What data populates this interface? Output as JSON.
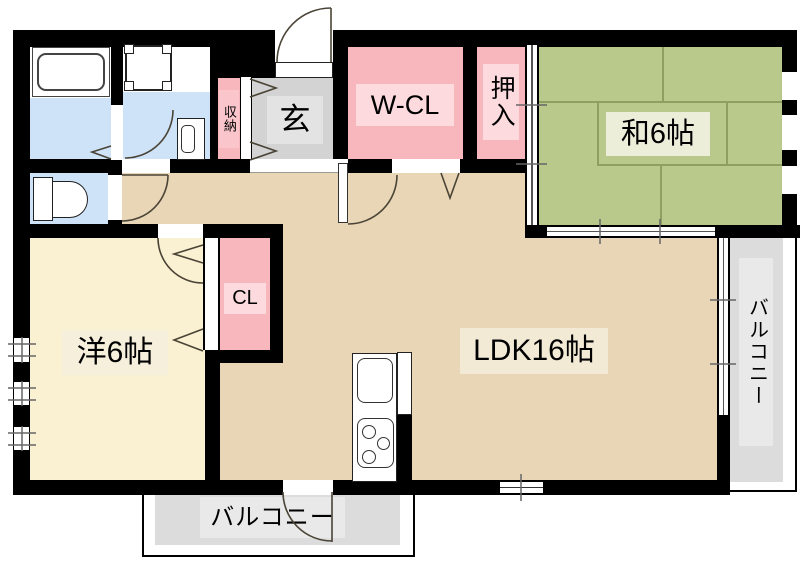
{
  "rooms": {
    "washitsu": {
      "label": "和6帖"
    },
    "youshitsu": {
      "label": "洋6帖"
    },
    "ldk": {
      "label": "LDK16帖"
    },
    "wcl": {
      "label": "W-CL"
    },
    "oshiire": {
      "label": "押入"
    },
    "genkan": {
      "label": "玄"
    },
    "shuno": {
      "label": "収納"
    },
    "cl": {
      "label": "CL"
    },
    "balcony_right": {
      "label": "バルコニー"
    },
    "balcony_bottom": {
      "label": "バルコニー"
    }
  },
  "colors": {
    "wall": "#000000",
    "ldk_floor": "#e9d6b6",
    "western_floor": "#faf0d2",
    "tatami": "#b9c98b",
    "tatami_line": "#8f9e63",
    "closet_pink": "#f8b6bd",
    "closet_pink_light": "#fcdade",
    "wet_blue": "#cfe3f8",
    "entry_gray": "#d3d3d3",
    "entry_gray_light": "#e3e3e3",
    "balcony_gray": "#dcdcdc",
    "balcony_gray_light": "#e9e9e9",
    "label_cream": "#f6efdb",
    "tatami_label": "#edeeda",
    "line_dark": "#4a4436"
  }
}
